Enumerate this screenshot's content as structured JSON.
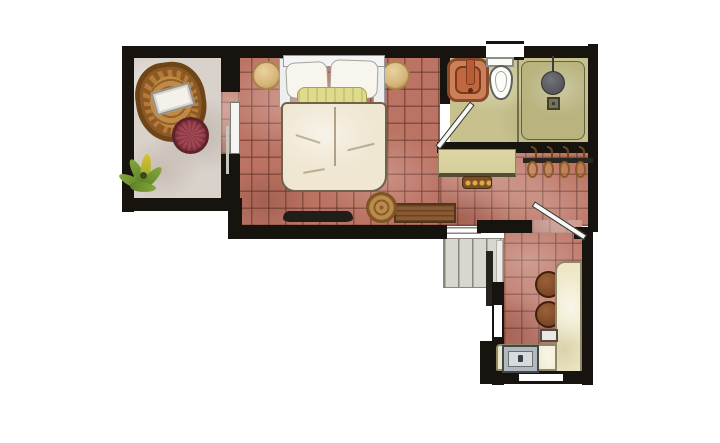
{
  "meta": {
    "title": "Hand-drawn watercolor floor plan",
    "style": "top-down architectural sketch, no text labels",
    "canvas": {
      "width": 720,
      "height": 443
    }
  },
  "palette": {
    "wall": "#17130e",
    "tile": "#bb7363",
    "grayFloor": "#d9d2ca",
    "olive": "#c7c18e",
    "shower": "#b9b37e",
    "counter": "#ede7c5",
    "desk": "#d5ce9c",
    "duvet": "#f0e7d3",
    "pillow": "#f7f5ee",
    "bolster": "#dedb8c",
    "wicker": "#b5793a",
    "wickerDark": "#6f4517",
    "ottoman": "#8e3a45",
    "stoolTan": "#d6b57a",
    "pouf": "#bc8b4b",
    "bench": "#8a5a33",
    "barStool": "#7a4526",
    "sink": "#cd8058",
    "toilet": "#fcfcf9",
    "showerHead": "#55555a",
    "plant": "#5d8226",
    "stair": "#d9d5cf",
    "appliance": "#b3b8bd"
  },
  "rooms": [
    {
      "id": "lounge",
      "name": "sitting nook",
      "floor": "gray wash",
      "contents": [
        "wicker egg chair with white cushion",
        "red striped ottoman",
        "potted plant"
      ]
    },
    {
      "id": "bedroom",
      "name": "bedroom",
      "floor": "terracotta tile",
      "contents": [
        "double bed with white pillows and yellow bolster",
        "two tan bedside stools",
        "tv console",
        "spiral pouf",
        "wooden bench"
      ]
    },
    {
      "id": "bathroom",
      "name": "bathroom",
      "floor": "olive wash",
      "contents": [
        "terracotta vessel sink",
        "toilet under window",
        "walk-in shower with head and drain",
        "inward swinging door"
      ]
    },
    {
      "id": "dressing",
      "name": "dressing nook",
      "floor": "terracotta tile",
      "contents": [
        "olive vanity desk",
        "small studded stool",
        "clothes rail with four wooden hangers"
      ]
    },
    {
      "id": "stairwell",
      "name": "stairwell",
      "floor": "gray treads",
      "contents": [
        "landing steps",
        "straight stair run",
        "dark handrail"
      ]
    },
    {
      "id": "kitchenette",
      "name": "kitchenette",
      "floor": "terracotta tile",
      "contents": [
        "L-shaped cream counter",
        "two round bar stools",
        "inset sink unit",
        "side window",
        "bottom window",
        "swinging door"
      ]
    }
  ],
  "windows": [
    {
      "id": "bathroom-window",
      "location": "top wall above toilet"
    },
    {
      "id": "kitchenette-side-window",
      "location": "left wall of kitchenette"
    },
    {
      "id": "kitchenette-bottom-window",
      "location": "bottom wall of kitchenette"
    }
  ]
}
